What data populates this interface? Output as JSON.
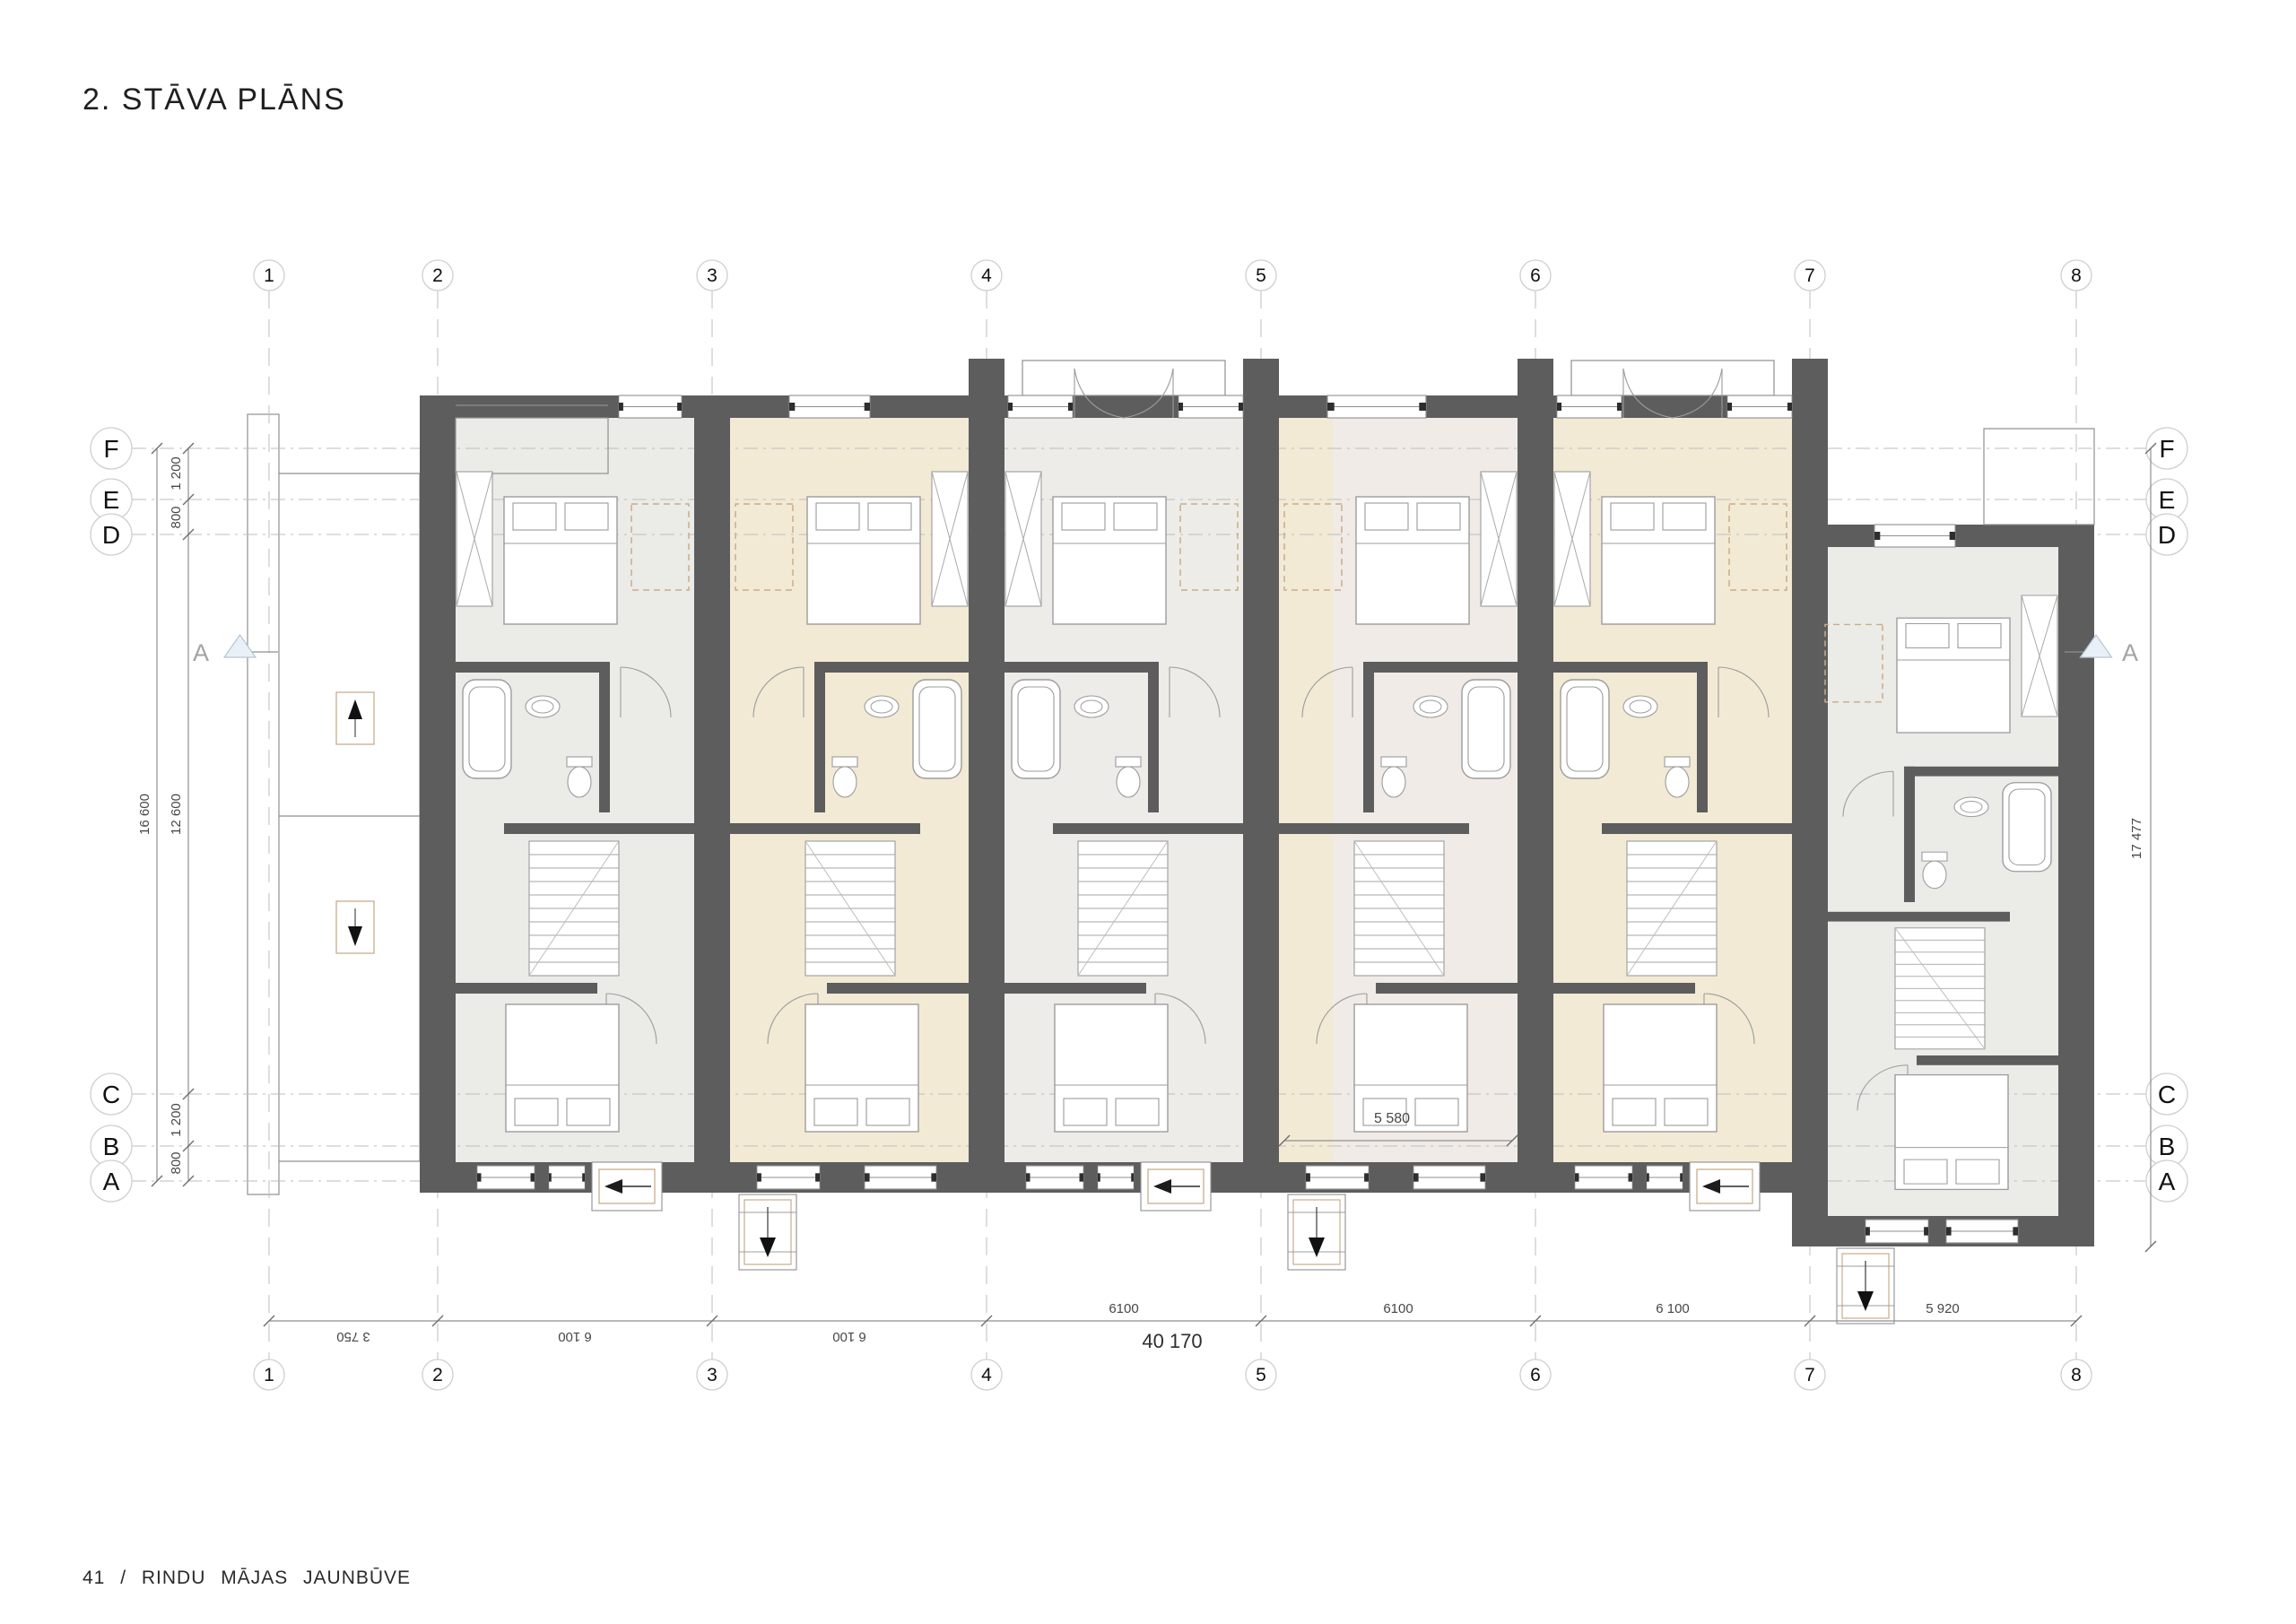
{
  "title": "2. STĀVA PLĀNS",
  "footer": "41 / RINDU MĀJAS JAUNBŪVE",
  "section_label": "A",
  "grid": {
    "columns": [
      "1",
      "2",
      "3",
      "4",
      "5",
      "6",
      "7",
      "8"
    ],
    "rows": [
      "F",
      "E",
      "D",
      "C",
      "B",
      "A"
    ]
  },
  "dims": {
    "col": [
      "3 750",
      "6 100",
      "6 100",
      "6100",
      "6100",
      "6 100",
      "5 920"
    ],
    "total": "40 170",
    "fe": "1 200",
    "ed": "800",
    "cb": "1 200",
    "ba": "800",
    "overall_height": "16 600",
    "inner_height": "12 600",
    "right_height": "17 477",
    "unit4_width": "5 580"
  },
  "colors": {
    "wall": "#5d5d5d",
    "unit_gray": "#ebebe7",
    "unit_gray2": "#edece8",
    "unit_beige": "#f2ead5",
    "unit_pink": "#f0ebe7",
    "tan": "#c9ad8b",
    "triangle_fill": "#e9f0f7",
    "triangle_stroke": "#b7c5d3"
  }
}
